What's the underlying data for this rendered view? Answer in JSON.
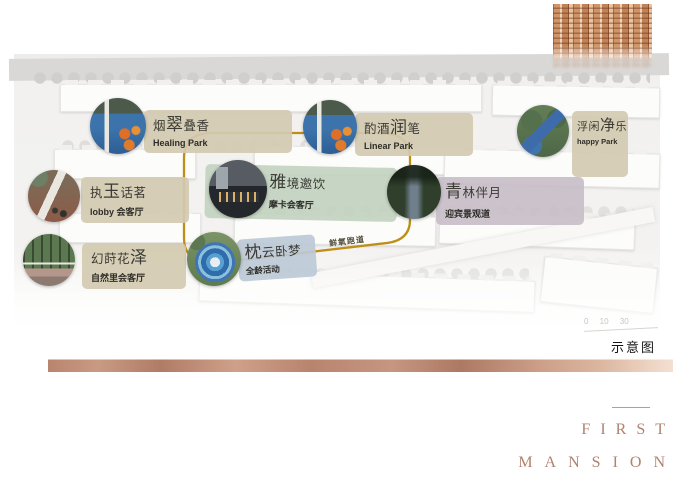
{
  "map": {
    "note": "示意图",
    "scale_text": "0 10 30",
    "track_label": "鲜氧跑道",
    "track_color": "#bd8f17"
  },
  "callouts": [
    {
      "title_pre": "烟",
      "title_big": "翠",
      "title_post": "叠香",
      "subtitle": "Healing Park",
      "box_color": "#d2cab0",
      "photo": "playground-blue-orange"
    },
    {
      "title_pre": "酌酒",
      "title_big": "润",
      "title_post": "笔",
      "subtitle": "Linear Park",
      "box_color": "#d2cab0",
      "photo": "playground-blue-orange"
    },
    {
      "title_pre": "浮闲",
      "title_big": "净",
      "title_post": "乐",
      "subtitle": "happy Park",
      "box_color": "#d2cab0",
      "photo": "trees-blue-slide"
    },
    {
      "title_pre": "执",
      "title_big": "玉",
      "title_post": "话茗",
      "subtitle": "lobby 会客厅",
      "box_color": "#d2cab0",
      "photo": "brick-plaza"
    },
    {
      "title_pre": "",
      "title_big": "雅",
      "title_post": "境邀饮",
      "subtitle": "摩卡会客厅",
      "box_color": "#c1d2bf",
      "photo": "night-clubhouse"
    },
    {
      "title_pre": "",
      "title_big": "青",
      "title_post": "林伴月",
      "subtitle": "迎宾景观道",
      "box_color": "#c6bcc7",
      "photo": "tree-lined-path"
    },
    {
      "title_pre": "幻莳花",
      "title_big": "泽",
      "title_post": "",
      "subtitle": "自然里会客厅",
      "box_color": "#d2cab0",
      "photo": "nature-garden"
    },
    {
      "title_pre": "",
      "title_big": "枕",
      "title_post": "云卧梦",
      "subtitle": "全龄活动",
      "box_color": "#bcc9d6",
      "photo": "aerial-play-circle"
    }
  ],
  "brand": {
    "line1": "FIRST",
    "line2": "MANSION",
    "color": "#b0826f"
  },
  "colors": {
    "copper_bar": "#c49179",
    "tan_box": "#d2cab0",
    "green_box": "#c1d2bf",
    "mauve_box": "#c6bcc7",
    "blue_box": "#bcc9d6",
    "track_gold": "#bd8f17"
  }
}
